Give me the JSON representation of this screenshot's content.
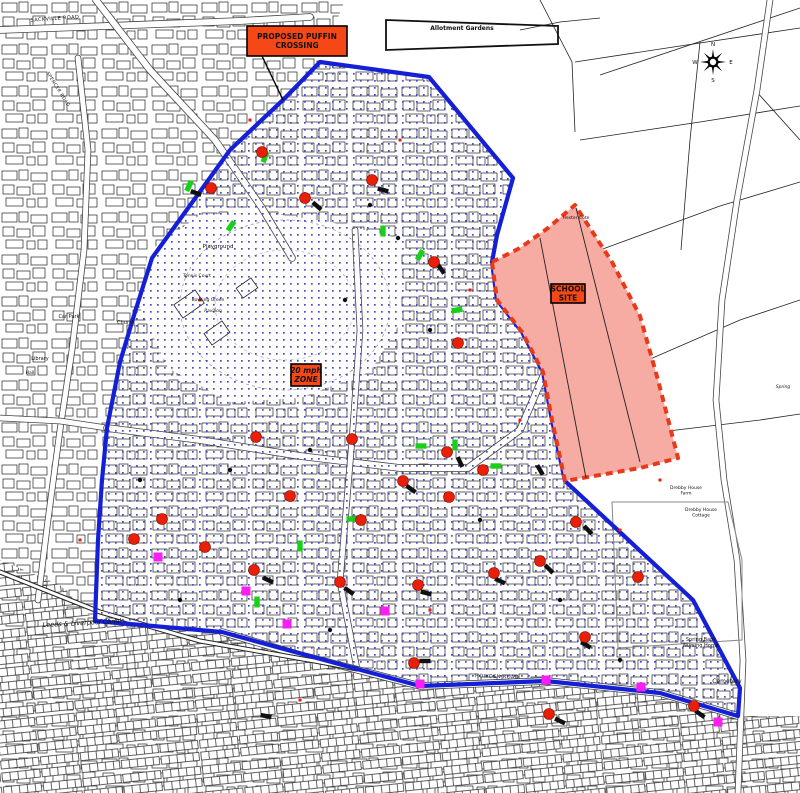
{
  "map": {
    "colors": {
      "boundary_blue": "#1520d6",
      "stipple_blue": "#4a4ac8",
      "school_fill": "#f6aba3",
      "school_stroke": "#e8391a",
      "label_box_orange": "#f64816",
      "marker_red": "#e92007",
      "marker_green": "#18cf1a",
      "marker_magenta": "#fb1ef2",
      "marker_black": "#101010",
      "building_line": "#222222"
    },
    "label_boxes": {
      "puffin": {
        "lines": [
          "PROPOSED PUFFIN",
          "CROSSING"
        ],
        "x": 247,
        "y": 26,
        "w": 100,
        "h": 30,
        "leader": [
          262,
          56,
          283,
          100
        ]
      },
      "school": {
        "lines": [
          "SCHOOL",
          "SITE"
        ],
        "x": 551,
        "y": 284,
        "w": 34,
        "h": 19
      },
      "zone": {
        "lines": [
          "20 mph",
          "ZONE"
        ],
        "x": 291,
        "y": 364,
        "w": 30,
        "h": 22
      }
    },
    "compass": {
      "x": 713,
      "y": 62,
      "n": "N",
      "e": "E",
      "s": "S",
      "w": "W"
    },
    "labels": [
      {
        "t": "SACKVILLE ROAD",
        "x": 55,
        "y": 20,
        "r": -4,
        "s": 5,
        "c": "road-lbl"
      },
      {
        "t": "SPENCER ROAD",
        "x": 57,
        "y": 90,
        "r": 58,
        "s": 4.5,
        "c": "road-lbl"
      },
      {
        "t": "Allotment Gardens",
        "x": 462,
        "y": 30,
        "r": 0,
        "s": 6,
        "c": "bold"
      },
      {
        "t": "Hester Cote",
        "x": 576,
        "y": 219,
        "r": 0,
        "s": 4.5,
        "c": ""
      },
      {
        "t": "Playground",
        "x": 218,
        "y": 248,
        "r": 0,
        "s": 5.5,
        "c": ""
      },
      {
        "t": "Tennis Court",
        "x": 197,
        "y": 277,
        "r": 0,
        "s": 4.5,
        "c": ""
      },
      {
        "t": "Bowling Green",
        "x": 208,
        "y": 301,
        "r": 0,
        "s": 4.5,
        "c": ""
      },
      {
        "t": "Pavilion",
        "x": 213,
        "y": 312,
        "r": 0,
        "s": 4.5,
        "c": "italic"
      },
      {
        "t": "Car Park",
        "x": 69,
        "y": 318,
        "r": 0,
        "s": 5,
        "c": ""
      },
      {
        "t": "Church",
        "x": 126,
        "y": 324,
        "r": 0,
        "s": 5,
        "c": ""
      },
      {
        "t": "Library",
        "x": 40,
        "y": 360,
        "r": 0,
        "s": 5,
        "c": ""
      },
      {
        "t": "Hall",
        "x": 30,
        "y": 374,
        "r": 0,
        "s": 4.5,
        "c": ""
      },
      {
        "t": "Leeds & Liverpool Canal",
        "x": 82,
        "y": 625,
        "r": -3,
        "s": 6.5,
        "c": "italic"
      },
      {
        "t": "Spring Bank\nNursing Home",
        "x": 701,
        "y": 641,
        "r": 0,
        "s": 5,
        "c": ""
      },
      {
        "t": "Cemetery",
        "x": 727,
        "y": 683,
        "r": 0,
        "s": 6,
        "c": ""
      },
      {
        "t": "Drebby House\nFarm",
        "x": 686,
        "y": 489,
        "r": 0,
        "s": 4.5,
        "c": ""
      },
      {
        "t": "Drebby House\nCottage",
        "x": 701,
        "y": 511,
        "r": 0,
        "s": 4.5,
        "c": ""
      },
      {
        "t": "HOWDEN ROAD",
        "x": 497,
        "y": 678,
        "r": 2,
        "s": 5,
        "c": "road-lbl"
      },
      {
        "t": "Spring",
        "x": 783,
        "y": 388,
        "r": 0,
        "s": 4.5,
        "c": "italic"
      }
    ],
    "boundary_points": [
      [
        320,
        62
      ],
      [
        429,
        77
      ],
      [
        513,
        178
      ],
      [
        497,
        235
      ],
      [
        492,
        262
      ],
      [
        497,
        300
      ],
      [
        522,
        332
      ],
      [
        543,
        372
      ],
      [
        552,
        420
      ],
      [
        565,
        481
      ],
      [
        693,
        600
      ],
      [
        740,
        688
      ],
      [
        738,
        716
      ],
      [
        660,
        693
      ],
      [
        546,
        681
      ],
      [
        420,
        686
      ],
      [
        357,
        669
      ],
      [
        222,
        632
      ],
      [
        95,
        621
      ],
      [
        98,
        540
      ],
      [
        102,
        480
      ],
      [
        107,
        428
      ],
      [
        120,
        362
      ],
      [
        135,
        312
      ],
      [
        152,
        258
      ],
      [
        230,
        150
      ],
      [
        285,
        98
      ]
    ],
    "school_site": {
      "points": [
        [
          492,
          262
        ],
        [
          520,
          248
        ],
        [
          548,
          228
        ],
        [
          575,
          205
        ],
        [
          612,
          262
        ],
        [
          640,
          316
        ],
        [
          658,
          380
        ],
        [
          678,
          458
        ],
        [
          640,
          468
        ],
        [
          565,
          481
        ],
        [
          552,
          420
        ],
        [
          543,
          372
        ],
        [
          522,
          332
        ],
        [
          497,
          300
        ]
      ],
      "inner_lines": [
        [
          540,
          238,
          586,
          478
        ],
        [
          576,
          208,
          640,
          462
        ]
      ]
    },
    "rural_points": [
      [
        320,
        62
      ],
      [
        429,
        77
      ],
      [
        513,
        178
      ],
      [
        497,
        235
      ],
      [
        492,
        262
      ],
      [
        497,
        300
      ],
      [
        522,
        332
      ],
      [
        543,
        372
      ],
      [
        552,
        420
      ],
      [
        565,
        481
      ],
      [
        693,
        600
      ],
      [
        740,
        688
      ],
      [
        738,
        716
      ],
      [
        800,
        716
      ],
      [
        800,
        0
      ],
      [
        345,
        0
      ]
    ],
    "park_points": [
      [
        148,
        252
      ],
      [
        200,
        215
      ],
      [
        262,
        212
      ],
      [
        330,
        222
      ],
      [
        398,
        238
      ],
      [
        402,
        320
      ],
      [
        370,
        372
      ],
      [
        300,
        398
      ],
      [
        230,
        402
      ],
      [
        168,
        368
      ],
      [
        140,
        308
      ]
    ],
    "field_lines": [
      [
        540,
        0,
        572,
        62,
        575,
        132
      ],
      [
        575,
        62,
        680,
        46,
        800,
        28
      ],
      [
        600,
        75,
        800,
        8
      ],
      [
        580,
        140,
        700,
        122,
        800,
        106
      ],
      [
        600,
        250,
        720,
        206,
        800,
        182
      ],
      [
        648,
        360,
        740,
        320,
        800,
        300
      ],
      [
        660,
        432,
        760,
        420,
        800,
        414
      ],
      [
        700,
        42,
        690,
        140,
        681,
        250
      ],
      [
        755,
        90,
        800,
        140
      ],
      [
        520,
        30,
        560,
        22,
        600,
        18
      ]
    ],
    "roads": [
      {
        "w": 6,
        "p": [
          [
            0,
            30
          ],
          [
            240,
            21
          ],
          [
            310,
            17
          ]
        ]
      },
      {
        "w": 6,
        "p": [
          [
            96,
            0
          ],
          [
            150,
            70
          ],
          [
            215,
            140
          ],
          [
            262,
            208
          ],
          [
            292,
            258
          ]
        ]
      },
      {
        "w": 5,
        "p": [
          [
            78,
            58
          ],
          [
            88,
            150
          ],
          [
            84,
            250
          ],
          [
            72,
            350
          ],
          [
            60,
            430
          ],
          [
            48,
            520
          ],
          [
            38,
            600
          ]
        ]
      },
      {
        "w": 5,
        "p": [
          [
            0,
            418
          ],
          [
            60,
            421
          ],
          [
            107,
            428
          ]
        ]
      },
      {
        "w": 6,
        "p": [
          [
            107,
            428
          ],
          [
            200,
            440
          ],
          [
            300,
            456
          ],
          [
            400,
            468
          ],
          [
            468,
            468
          ],
          [
            520,
            430
          ],
          [
            545,
            372
          ]
        ]
      },
      {
        "w": 5,
        "p": [
          [
            355,
            230
          ],
          [
            360,
            330
          ],
          [
            352,
            440
          ],
          [
            340,
            582
          ],
          [
            357,
            669
          ]
        ]
      },
      {
        "w": 6,
        "p": [
          [
            222,
            632
          ],
          [
            300,
            655
          ],
          [
            420,
            686
          ],
          [
            546,
            681
          ],
          [
            660,
            693
          ],
          [
            738,
            716
          ]
        ]
      },
      {
        "w": 5,
        "p": [
          [
            770,
            0
          ],
          [
            757,
            90
          ],
          [
            737,
            200
          ],
          [
            722,
            300
          ],
          [
            716,
            400
          ],
          [
            724,
            480
          ],
          [
            737,
            560
          ],
          [
            743,
            660
          ],
          [
            738,
            793
          ]
        ]
      }
    ],
    "canal": [
      [
        0,
        572
      ],
      [
        100,
        612
      ],
      [
        200,
        641
      ],
      [
        320,
        662
      ],
      [
        357,
        669
      ]
    ],
    "cemetery_outline": [
      [
        612,
        502
      ],
      [
        728,
        502
      ],
      [
        742,
        560
      ],
      [
        742,
        640
      ],
      [
        618,
        648
      ]
    ],
    "allotment_band": [
      [
        386,
        20
      ],
      [
        558,
        26
      ],
      [
        558,
        44
      ],
      [
        386,
        50
      ]
    ],
    "markers": {
      "red_circles": [
        [
          211,
          188
        ],
        [
          262,
          152
        ],
        [
          305,
          198
        ],
        [
          372,
          180
        ],
        [
          434,
          262
        ],
        [
          458,
          343
        ],
        [
          256,
          437
        ],
        [
          352,
          439
        ],
        [
          447,
          452
        ],
        [
          403,
          481
        ],
        [
          449,
          497
        ],
        [
          290,
          496
        ],
        [
          361,
          520
        ],
        [
          483,
          470
        ],
        [
          576,
          522
        ],
        [
          540,
          561
        ],
        [
          494,
          573
        ],
        [
          418,
          585
        ],
        [
          340,
          582
        ],
        [
          254,
          570
        ],
        [
          205,
          547
        ],
        [
          162,
          519
        ],
        [
          134,
          539
        ],
        [
          585,
          637
        ],
        [
          638,
          577
        ],
        [
          414,
          663
        ],
        [
          549,
          714
        ],
        [
          694,
          706
        ]
      ],
      "green_bars": [
        [
          189,
          186,
          25
        ],
        [
          231,
          226,
          35
        ],
        [
          265,
          157,
          20
        ],
        [
          383,
          231,
          0
        ],
        [
          420,
          255,
          30
        ],
        [
          457,
          310,
          80
        ],
        [
          421,
          446,
          90
        ],
        [
          455,
          445,
          0
        ],
        [
          496,
          466,
          90
        ],
        [
          352,
          519,
          90
        ],
        [
          300,
          546,
          0
        ],
        [
          257,
          602,
          0
        ]
      ],
      "magenta_squares": [
        [
          158,
          557
        ],
        [
          246,
          591
        ],
        [
          287,
          624
        ],
        [
          385,
          611
        ],
        [
          420,
          684
        ],
        [
          546,
          680
        ],
        [
          641,
          687
        ],
        [
          718,
          722
        ]
      ],
      "black_bars": [
        [
          196,
          193,
          20
        ],
        [
          317,
          206,
          40
        ],
        [
          383,
          190,
          15
        ],
        [
          441,
          269,
          55
        ],
        [
          411,
          489,
          35
        ],
        [
          460,
          462,
          65
        ],
        [
          500,
          581,
          25
        ],
        [
          549,
          569,
          45
        ],
        [
          426,
          593,
          15
        ],
        [
          349,
          591,
          35
        ],
        [
          268,
          580,
          25
        ],
        [
          588,
          530,
          45
        ],
        [
          425,
          661,
          0
        ],
        [
          560,
          721,
          25
        ],
        [
          700,
          714,
          35
        ],
        [
          266,
          716,
          10
        ],
        [
          586,
          645,
          30
        ],
        [
          540,
          470,
          60
        ]
      ],
      "black_dots": [
        [
          370,
          205
        ],
        [
          398,
          238
        ],
        [
          345,
          300
        ],
        [
          430,
          330
        ],
        [
          310,
          450
        ],
        [
          230,
          470
        ],
        [
          480,
          520
        ],
        [
          560,
          600
        ],
        [
          620,
          660
        ],
        [
          180,
          600
        ],
        [
          140,
          480
        ],
        [
          330,
          630
        ]
      ],
      "red_ticks": [
        [
          250,
          120
        ],
        [
          400,
          140
        ],
        [
          470,
          290
        ],
        [
          200,
          300
        ],
        [
          520,
          420
        ],
        [
          80,
          540
        ],
        [
          300,
          700
        ],
        [
          620,
          530
        ],
        [
          430,
          610
        ],
        [
          660,
          480
        ]
      ]
    }
  }
}
